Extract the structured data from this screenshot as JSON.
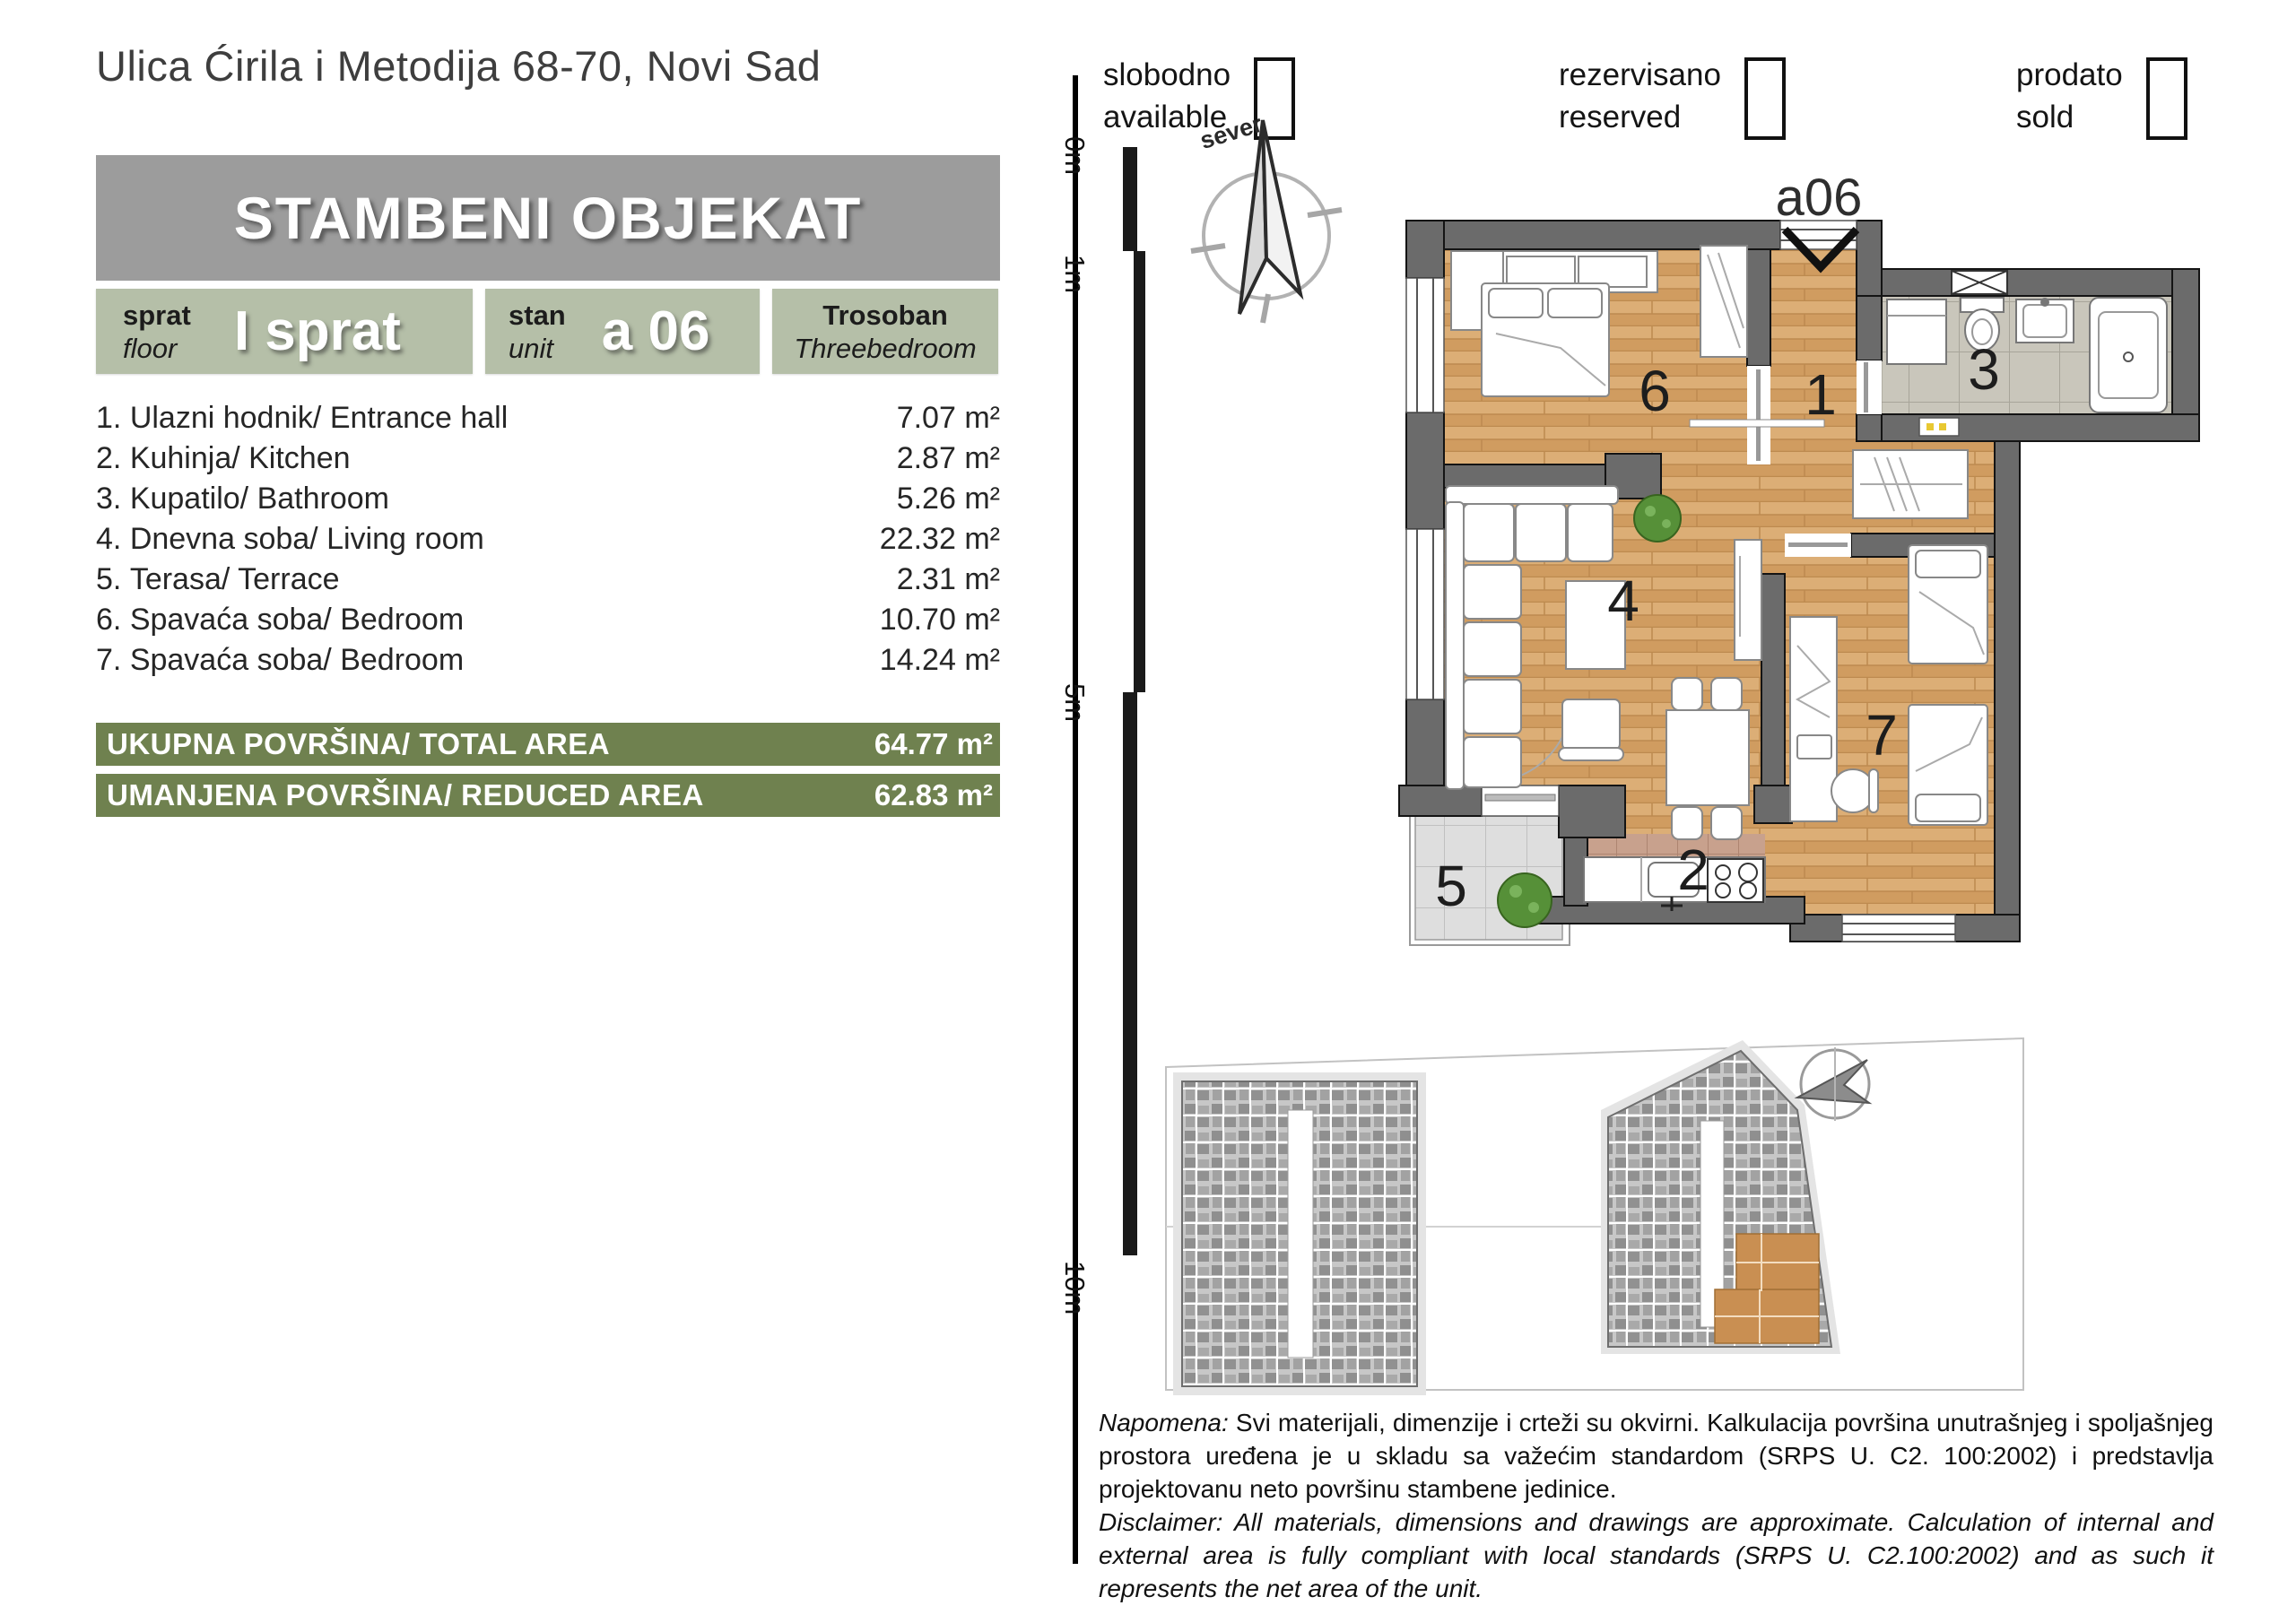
{
  "address": "Ulica Ćirila i Metodija 68-70, Novi Sad",
  "header": {
    "title": "STAMBENI OBJEKAT"
  },
  "badges": {
    "floor": {
      "label_sr": "sprat",
      "label_en": "floor",
      "value": "I sprat"
    },
    "unit": {
      "label_sr": "stan",
      "label_en": "unit",
      "value": "a 06"
    },
    "type": {
      "label_sr": "Trosoban",
      "label_en": "Threebedroom"
    }
  },
  "area_unit": "m²",
  "rooms": [
    {
      "num": "1. ",
      "name": "Ulazni hodnik/ Entrance hall",
      "area": "7.07"
    },
    {
      "num": "2. ",
      "name": "Kuhinja/ Kitchen",
      "area": "2.87"
    },
    {
      "num": "3. ",
      "name": "Kupatilo/ Bathroom",
      "area": "5.26"
    },
    {
      "num": "4. ",
      "name": "Dnevna soba/ Living room",
      "area": "22.32"
    },
    {
      "num": "5. ",
      "name": "Terasa/ Terrace",
      "area": "2.31"
    },
    {
      "num": "6. ",
      "name": "Spavaća soba/ Bedroom",
      "area": "10.70"
    },
    {
      "num": "7. ",
      "name": "Spavaća soba/ Bedroom",
      "area": "14.24"
    }
  ],
  "totals": [
    {
      "label": "UKUPNA POVRŠINA/ TOTAL AREA",
      "value": "64.77"
    },
    {
      "label": "UMANJENA POVRŠINA/ REDUCED AREA",
      "value": "62.83"
    }
  ],
  "legend": [
    {
      "sr": "slobodno",
      "en": "available"
    },
    {
      "sr": "rezervisano",
      "en": "reserved"
    },
    {
      "sr": "prodato",
      "en": "sold"
    }
  ],
  "scale_ruler": {
    "labels": [
      "0m",
      "1m",
      "5m",
      "10m"
    ]
  },
  "compass": {
    "north_label": "sever"
  },
  "floor_plan": {
    "unit_label": "a06",
    "room_numbers": [
      "1",
      "2",
      "3",
      "4",
      "5",
      "6",
      "7"
    ]
  },
  "disclaimer": {
    "sr_label": "Napomena:",
    "sr_text": " Svi materijali, dimenzije i crteži su okvirni. Kalkulacija površina unutrašnjeg i spoljašnjeg prostora uređena je u skladu sa važećim standardom (SRPS U. C2. 100:2002) i predstavlja projektovanu neto površinu stambene jedinice.",
    "en_text": "Disclaimer: All materials, dimensions and drawings are approximate. Calculation of internal and external area is fully compliant with local standards (SRPS U. C2.100:2002) and as such it represents the net area of the unit."
  },
  "colors": {
    "header_gray": "#9c9c9c",
    "badge_green": "#b5bfa8",
    "total_bar_green": "#6f814f",
    "wall_gray": "#6b6b6b",
    "wood_floor": "#d6a56b",
    "highlight_unit": "#c98f52"
  }
}
